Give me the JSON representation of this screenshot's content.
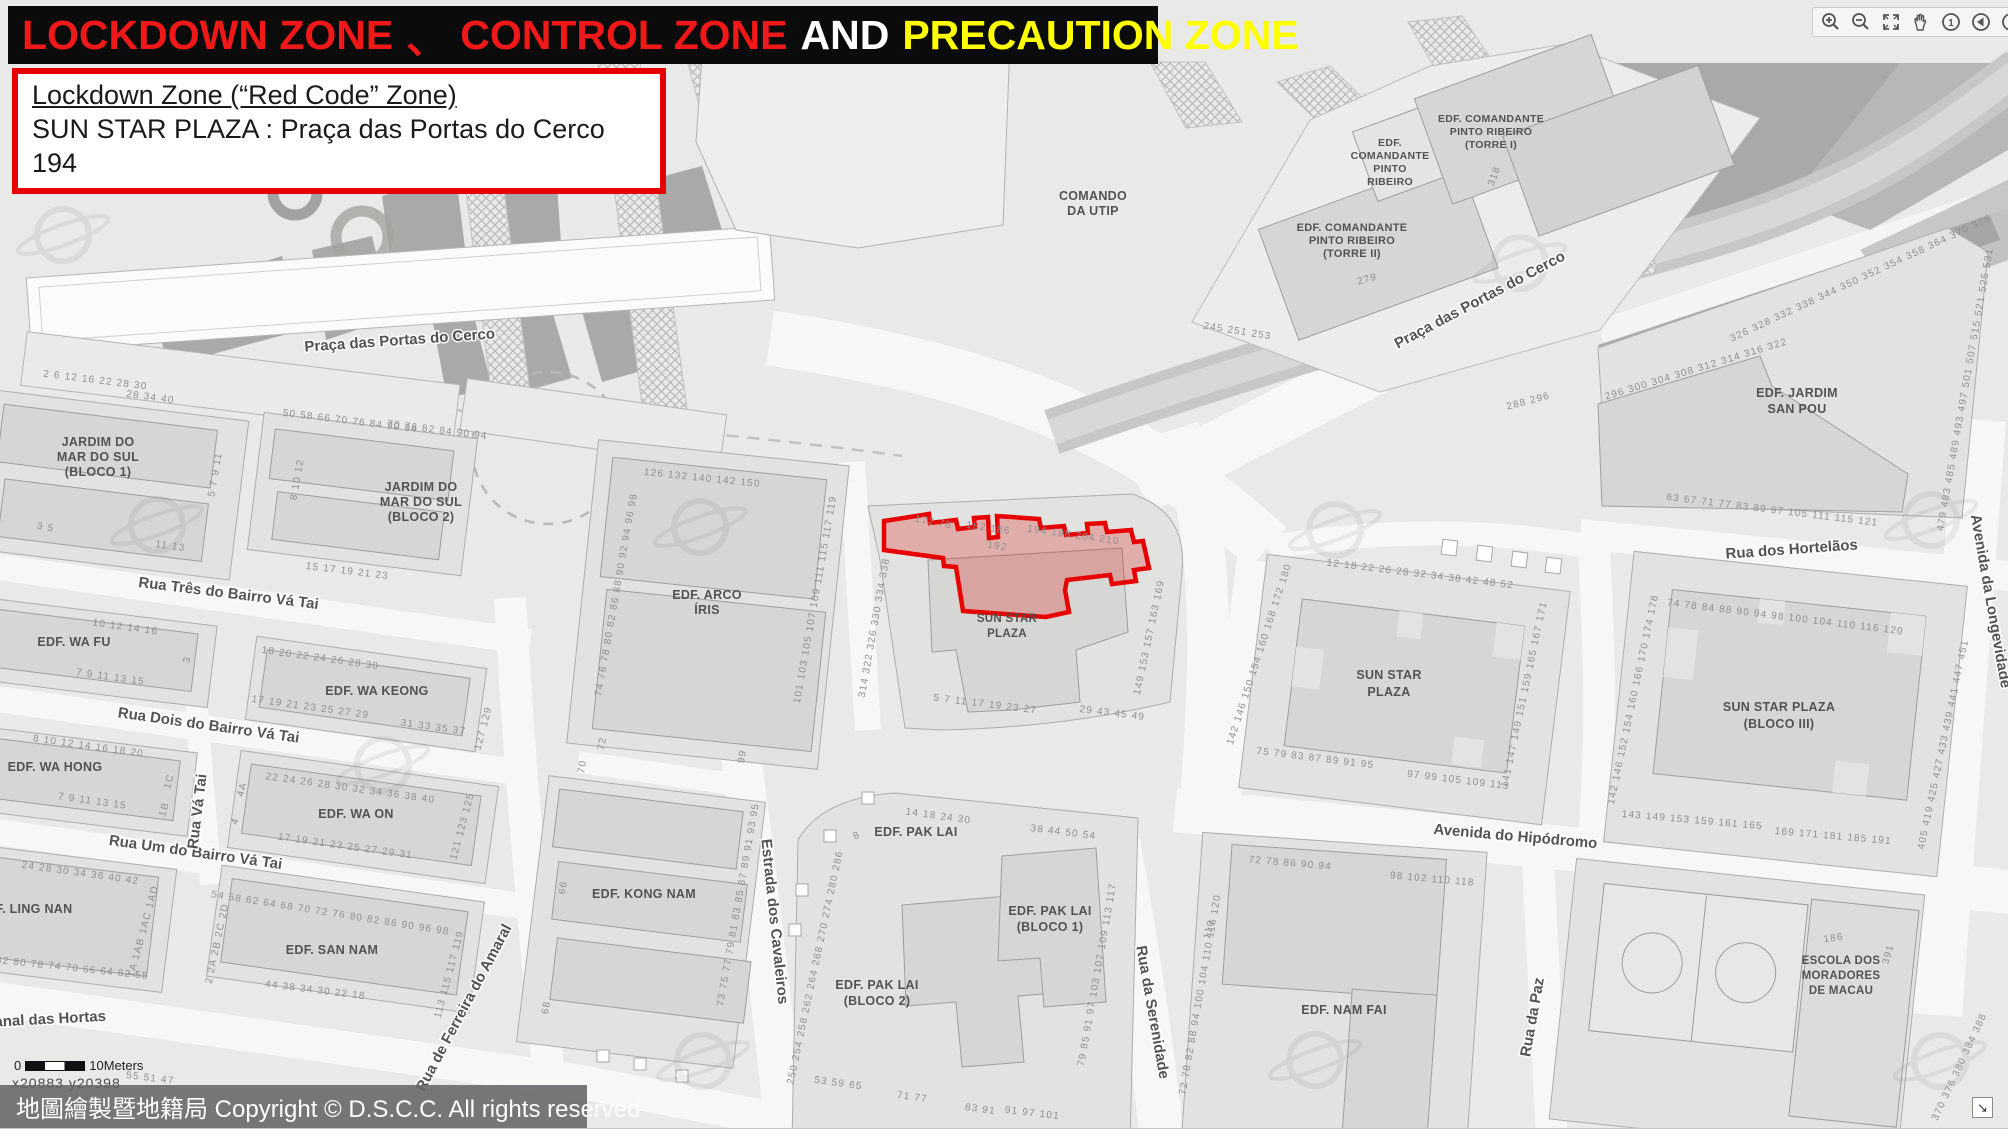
{
  "header": {
    "title_parts": [
      {
        "text": "LOCKDOWN ZONE",
        "color": "#f01818"
      },
      {
        "text": "、",
        "color": "#f01818"
      },
      {
        "text": "CONTROL ZONE",
        "color": "#f01818"
      },
      {
        "text": "AND",
        "color": "#ffffff"
      },
      {
        "text": "PRECAUTION ZONE",
        "color": "#ffff00"
      }
    ]
  },
  "info_box": {
    "line1": "Lockdown Zone (“Red Code” Zone)",
    "line2": "SUN STAR PLAZA :  Praça das Portas do Cerco 194"
  },
  "footer": {
    "copyright": "地圖繪製暨地籍局 Copyright © D.S.C.C. All rights reserved",
    "scale_zero": "0",
    "scale_label": "10Meters",
    "coords": "x20883  y20398"
  },
  "icons": {
    "home_digit": "1",
    "resize_arrow": "↘"
  },
  "colors": {
    "zone_stroke": "#e60000",
    "zone_fill": "rgba(220,30,30,0.27)"
  },
  "map": {
    "labels": [
      {
        "t": "Praça das Portas do Cerco",
        "x": 400,
        "y": 345,
        "r": -4,
        "k": "s"
      },
      {
        "t": "Praça das Portas do Cerco",
        "x": 1482,
        "y": 304,
        "r": -28,
        "k": "s"
      },
      {
        "t": "Rua Três do Bairro Vá Tai",
        "x": 228,
        "y": 598,
        "r": 7,
        "k": "s"
      },
      {
        "t": "Rua Dois do Bairro Vá Tai",
        "x": 208,
        "y": 730,
        "r": 8,
        "k": "s"
      },
      {
        "t": "Rua Um do Bairro Vá Tai",
        "x": 195,
        "y": 857,
        "r": 8,
        "k": "s"
      },
      {
        "t": "Rua Vá Tai",
        "x": 202,
        "y": 812,
        "r": -83,
        "k": "s"
      },
      {
        "t": "Canal das Hortas",
        "x": 45,
        "y": 1024,
        "r": -3,
        "k": "s"
      },
      {
        "t": "Rua de Ferreira do Amaral",
        "x": 468,
        "y": 1010,
        "r": -62,
        "k": "s"
      },
      {
        "t": "Estrada dos Cavaleiros",
        "x": 770,
        "y": 922,
        "r": 84,
        "k": "s"
      },
      {
        "t": "Rua da Serenidade",
        "x": 1148,
        "y": 1013,
        "r": 80,
        "k": "s"
      },
      {
        "t": "Avenida do Hipódromo",
        "x": 1515,
        "y": 841,
        "r": 5,
        "k": "s"
      },
      {
        "t": "Rua dos Hortelãos",
        "x": 1792,
        "y": 554,
        "r": -4,
        "k": "s"
      },
      {
        "t": "Avenida da Longevidade",
        "x": 1986,
        "y": 602,
        "r": 80,
        "k": "s"
      },
      {
        "t": "Rua da Paz",
        "x": 1537,
        "y": 1018,
        "r": -80,
        "k": "s"
      },
      {
        "t": "JARDIM DO",
        "x": 98,
        "y": 446,
        "r": 0,
        "k": "b"
      },
      {
        "t": "MAR DO SUL",
        "x": 98,
        "y": 461,
        "r": 0,
        "k": "b"
      },
      {
        "t": "(BLOCO 1)",
        "x": 98,
        "y": 476,
        "r": 0,
        "k": "b"
      },
      {
        "t": "JARDIM DO",
        "x": 421,
        "y": 491,
        "r": 0,
        "k": "b"
      },
      {
        "t": "MAR DO SUL",
        "x": 421,
        "y": 506,
        "r": 0,
        "k": "b"
      },
      {
        "t": "(BLOCO 2)",
        "x": 421,
        "y": 521,
        "r": 0,
        "k": "b"
      },
      {
        "t": "EDF. WA FU",
        "x": 74,
        "y": 646,
        "r": 0,
        "k": "b"
      },
      {
        "t": "EDF. WA KEONG",
        "x": 377,
        "y": 695,
        "r": 0,
        "k": "b"
      },
      {
        "t": "EDF. WA HONG",
        "x": 55,
        "y": 771,
        "r": 0,
        "k": "b"
      },
      {
        "t": "EDF. WA ON",
        "x": 356,
        "y": 818,
        "r": 0,
        "k": "b"
      },
      {
        "t": "EDF. LING NAN",
        "x": 25,
        "y": 913,
        "r": 0,
        "k": "b"
      },
      {
        "t": "EDF. SAN NAM",
        "x": 332,
        "y": 954,
        "r": 0,
        "k": "b"
      },
      {
        "t": "EDF. ARCO",
        "x": 707,
        "y": 599,
        "r": 0,
        "k": "b"
      },
      {
        "t": "ÍRIS",
        "x": 707,
        "y": 614,
        "r": 0,
        "k": "b"
      },
      {
        "t": "EDF. KONG NAM",
        "x": 644,
        "y": 898,
        "r": 0,
        "k": "b"
      },
      {
        "t": "SUN STAR",
        "x": 1007,
        "y": 622,
        "r": 0,
        "k": "b",
        "sz": 11.5
      },
      {
        "t": "PLAZA",
        "x": 1007,
        "y": 637,
        "r": 0,
        "k": "b",
        "sz": 11.5
      },
      {
        "t": "SUN STAR",
        "x": 1389,
        "y": 679,
        "r": 0,
        "k": "b"
      },
      {
        "t": "PLAZA",
        "x": 1389,
        "y": 696,
        "r": 0,
        "k": "b"
      },
      {
        "t": "SUN STAR PLAZA",
        "x": 1779,
        "y": 711,
        "r": 0,
        "k": "b"
      },
      {
        "t": "(BLOCO III)",
        "x": 1779,
        "y": 728,
        "r": 0,
        "k": "b"
      },
      {
        "t": "EDF. PAK LAI",
        "x": 916,
        "y": 836,
        "r": 0,
        "k": "b"
      },
      {
        "t": "EDF. PAK LAI",
        "x": 877,
        "y": 989,
        "r": 0,
        "k": "b"
      },
      {
        "t": "(BLOCO 2)",
        "x": 877,
        "y": 1005,
        "r": 0,
        "k": "b"
      },
      {
        "t": "EDF. PAK LAI",
        "x": 1050,
        "y": 915,
        "r": 0,
        "k": "b"
      },
      {
        "t": "(BLOCO 1)",
        "x": 1050,
        "y": 931,
        "r": 0,
        "k": "b"
      },
      {
        "t": "EDF. NAM FAI",
        "x": 1344,
        "y": 1014,
        "r": 0,
        "k": "b"
      },
      {
        "t": "EDF. JARDIM",
        "x": 1797,
        "y": 397,
        "r": 0,
        "k": "b"
      },
      {
        "t": "SAN POU",
        "x": 1797,
        "y": 413,
        "r": 0,
        "k": "b"
      },
      {
        "t": "COMANDO",
        "x": 1093,
        "y": 200,
        "r": 0,
        "k": "b"
      },
      {
        "t": "DA UTIP",
        "x": 1093,
        "y": 215,
        "r": 0,
        "k": "b"
      },
      {
        "t": "EDF.",
        "x": 1390,
        "y": 146,
        "r": 0,
        "k": "b",
        "sz": 10.5
      },
      {
        "t": "COMANDANTE",
        "x": 1390,
        "y": 159,
        "r": 0,
        "k": "b",
        "sz": 10.5
      },
      {
        "t": "PINTO",
        "x": 1390,
        "y": 172,
        "r": 0,
        "k": "b",
        "sz": 10.5
      },
      {
        "t": "RIBEIRO",
        "x": 1390,
        "y": 185,
        "r": 0,
        "k": "b",
        "sz": 10.5
      },
      {
        "t": "EDF. COMANDANTE",
        "x": 1491,
        "y": 122,
        "r": 0,
        "k": "b",
        "sz": 10.5
      },
      {
        "t": "PINTO RIBEIRO",
        "x": 1491,
        "y": 135,
        "r": 0,
        "k": "b",
        "sz": 10.5
      },
      {
        "t": "(TORRE I)",
        "x": 1491,
        "y": 148,
        "r": 0,
        "k": "b",
        "sz": 10.5
      },
      {
        "t": "EDF. COMANDANTE",
        "x": 1352,
        "y": 231,
        "r": 0,
        "k": "b",
        "sz": 11
      },
      {
        "t": "PINTO RIBEIRO",
        "x": 1352,
        "y": 244,
        "r": 0,
        "k": "b",
        "sz": 11
      },
      {
        "t": "(TORRE II)",
        "x": 1352,
        "y": 257,
        "r": 0,
        "k": "b",
        "sz": 11
      },
      {
        "t": "ESCOLA DOS",
        "x": 1841,
        "y": 964,
        "r": 0,
        "k": "b",
        "sz": 11.5
      },
      {
        "t": "MORADORES",
        "x": 1841,
        "y": 979,
        "r": 0,
        "k": "b",
        "sz": 11.5
      },
      {
        "t": "DE MACAU",
        "x": 1841,
        "y": 994,
        "r": 0,
        "k": "b",
        "sz": 11.5
      },
      {
        "t": "172  78",
        "x": 933,
        "y": 525,
        "r": 10,
        "k": "n"
      },
      {
        "t": "182  186",
        "x": 988,
        "y": 531,
        "r": 8,
        "k": "n"
      },
      {
        "t": "192",
        "x": 997,
        "y": 549,
        "r": 8,
        "k": "n"
      },
      {
        "t": "194  198 204 210",
        "x": 1073,
        "y": 538,
        "r": 8,
        "k": "n"
      },
      {
        "t": "314  322  326  330  334  338",
        "x": 877,
        "y": 628,
        "r": -80,
        "k": "n"
      },
      {
        "t": "5   7   11   17 19 23 27",
        "x": 985,
        "y": 707,
        "r": 7,
        "k": "n"
      },
      {
        "t": "29  43 45  49",
        "x": 1112,
        "y": 716,
        "r": 7,
        "k": "n"
      },
      {
        "t": "149  153  157  163  169",
        "x": 1152,
        "y": 638,
        "r": -78,
        "k": "n"
      },
      {
        "t": "126  132  140 142    150",
        "x": 702,
        "y": 481,
        "r": 6,
        "k": "n"
      },
      {
        "t": "74  76  78  80  82  86  88  90  92  94  96  98",
        "x": 619,
        "y": 595,
        "r": -80,
        "k": "n"
      },
      {
        "t": "101 103 105 107 109 111  115 117 119",
        "x": 818,
        "y": 600,
        "r": -80,
        "k": "n"
      },
      {
        "t": "70",
        "x": 585,
        "y": 767,
        "r": -80,
        "k": "n"
      },
      {
        "t": "72",
        "x": 605,
        "y": 744,
        "r": -80,
        "k": "n"
      },
      {
        "t": "99",
        "x": 745,
        "y": 757,
        "r": -80,
        "k": "n"
      },
      {
        "t": "73 75 77 79 81 83 85 87 89 91 93 95",
        "x": 741,
        "y": 905,
        "r": -80,
        "k": "n"
      },
      {
        "t": "66",
        "x": 566,
        "y": 888,
        "r": -80,
        "k": "n"
      },
      {
        "t": "68",
        "x": 549,
        "y": 1008,
        "r": -80,
        "k": "n"
      },
      {
        "t": "28  34  40",
        "x": 150,
        "y": 400,
        "r": 8,
        "k": "n"
      },
      {
        "t": "50  58   66  70  76   84  90  94",
        "x": 350,
        "y": 424,
        "r": 7,
        "k": "n"
      },
      {
        "t": "3   5",
        "x": 45,
        "y": 530,
        "r": 10,
        "k": "n"
      },
      {
        "t": "11   13",
        "x": 170,
        "y": 549,
        "r": 8,
        "k": "n"
      },
      {
        "t": "15   17   19   21   23",
        "x": 347,
        "y": 574,
        "r": 7,
        "k": "n"
      },
      {
        "t": "5  7  9  11",
        "x": 218,
        "y": 475,
        "r": -80,
        "k": "n"
      },
      {
        "t": "8  10  12",
        "x": 300,
        "y": 480,
        "r": -80,
        "k": "n"
      },
      {
        "t": "10   12   14   16",
        "x": 125,
        "y": 630,
        "r": 8,
        "k": "n"
      },
      {
        "t": "7   9   11   13  15",
        "x": 110,
        "y": 680,
        "r": 8,
        "k": "n"
      },
      {
        "t": "3",
        "x": 190,
        "y": 660,
        "r": -80,
        "k": "n"
      },
      {
        "t": "18   20 22 24   26 28 30",
        "x": 320,
        "y": 661,
        "r": 8,
        "k": "n"
      },
      {
        "t": "17   19 21 23   25 27 29",
        "x": 310,
        "y": 710,
        "r": 8,
        "k": "n"
      },
      {
        "t": "31  33  35  37",
        "x": 433,
        "y": 730,
        "r": 8,
        "k": "n"
      },
      {
        "t": "127  129",
        "x": 486,
        "y": 729,
        "r": -75,
        "k": "n"
      },
      {
        "t": "8   10   12   14   16 18 20",
        "x": 88,
        "y": 749,
        "r": 8,
        "k": "n"
      },
      {
        "t": "7   9   11   13 15",
        "x": 92,
        "y": 804,
        "r": 8,
        "k": "n"
      },
      {
        "t": "1C",
        "x": 172,
        "y": 782,
        "r": -75,
        "k": "n"
      },
      {
        "t": "1B",
        "x": 167,
        "y": 810,
        "r": -75,
        "k": "n"
      },
      {
        "t": "22   24   26   28   30   32   34   36 38 40",
        "x": 350,
        "y": 791,
        "r": 8,
        "k": "n"
      },
      {
        "t": "4A",
        "x": 245,
        "y": 790,
        "r": -75,
        "k": "n"
      },
      {
        "t": "4",
        "x": 238,
        "y": 822,
        "r": -70,
        "k": "n"
      },
      {
        "t": "17 19   21   23   25   27   29 31",
        "x": 345,
        "y": 849,
        "r": 8,
        "k": "n"
      },
      {
        "t": "121  123  125",
        "x": 465,
        "y": 827,
        "r": -75,
        "k": "n"
      },
      {
        "t": "24  28  30  34   36   40   42",
        "x": 80,
        "y": 876,
        "r": 8,
        "k": "n"
      },
      {
        "t": "1A 1AB 1AC 1AD",
        "x": 146,
        "y": 932,
        "r": -75,
        "k": "n"
      },
      {
        "t": "82 80 78 74  70 66 64 62  58",
        "x": 72,
        "y": 971,
        "r": 6,
        "k": "n"
      },
      {
        "t": "54   58 62   64 68 70 72   76 80 82   86 90 96 98",
        "x": 330,
        "y": 916,
        "r": 9,
        "k": "n"
      },
      {
        "t": "2  2A  2B  2C  2D",
        "x": 220,
        "y": 944,
        "r": -78,
        "k": "n"
      },
      {
        "t": "44      38      34      30      22      18",
        "x": 315,
        "y": 993,
        "r": 7,
        "k": "n"
      },
      {
        "t": "113  115  117  119",
        "x": 452,
        "y": 975,
        "r": -75,
        "k": "n"
      },
      {
        "t": "2   6   12 16 22 28 30",
        "x": 95,
        "y": 383,
        "r": 7,
        "k": "n"
      },
      {
        "t": "70  76  82  84  90  94",
        "x": 437,
        "y": 433,
        "r": 7,
        "k": "n"
      },
      {
        "t": "55   51   47",
        "x": 150,
        "y": 1081,
        "r": 7,
        "k": "n"
      },
      {
        "t": "250  254  258  262  264  268  270  274  280  286",
        "x": 818,
        "y": 968,
        "r": -78,
        "k": "n"
      },
      {
        "t": "8",
        "x": 858,
        "y": 838,
        "r": -30,
        "k": "n"
      },
      {
        "t": "14   18   24   30",
        "x": 938,
        "y": 819,
        "r": 8,
        "k": "n"
      },
      {
        "t": "38  44   50  54",
        "x": 1063,
        "y": 835,
        "r": 7,
        "k": "n"
      },
      {
        "t": "53   59   65",
        "x": 838,
        "y": 1086,
        "r": 8,
        "k": "n"
      },
      {
        "t": "71   77",
        "x": 912,
        "y": 1100,
        "r": 8,
        "k": "n"
      },
      {
        "t": "83   91",
        "x": 980,
        "y": 1112,
        "r": 8,
        "k": "n"
      },
      {
        "t": "79  85  91  97  103 107 109  113  117",
        "x": 1100,
        "y": 975,
        "r": -80,
        "k": "n"
      },
      {
        "t": "91   97   101",
        "x": 1032,
        "y": 1116,
        "r": 7,
        "k": "n"
      },
      {
        "t": "72  78  82  88  94  100  104  110  116  120",
        "x": 1203,
        "y": 995,
        "r": -80,
        "k": "n"
      },
      {
        "t": "72   78   86   90   94",
        "x": 1290,
        "y": 866,
        "r": 5,
        "k": "n"
      },
      {
        "t": "98  102  110  118",
        "x": 1432,
        "y": 882,
        "r": 5,
        "k": "n"
      },
      {
        "t": "110",
        "x": 1212,
        "y": 930,
        "r": -75,
        "k": "n"
      },
      {
        "t": "12   18   22   26   28   32   34   38   42   48   52",
        "x": 1420,
        "y": 577,
        "r": 7,
        "k": "n"
      },
      {
        "t": "142  146  150  154  160  168  172  180",
        "x": 1262,
        "y": 655,
        "r": -72,
        "k": "n"
      },
      {
        "t": "75   79   83   87   89   91   95",
        "x": 1315,
        "y": 761,
        "r": 7,
        "k": "n"
      },
      {
        "t": "97  99  105   109 113",
        "x": 1458,
        "y": 783,
        "r": 7,
        "k": "n"
      },
      {
        "t": "141  147  149  151  159  165  167  171",
        "x": 1527,
        "y": 695,
        "r": -78,
        "k": "n"
      },
      {
        "t": "74 78   84   88   90   94   98  100  104   110   116   120",
        "x": 1785,
        "y": 620,
        "r": 7,
        "k": "n"
      },
      {
        "t": "142  146  152  154  160  166  170  174  178",
        "x": 1636,
        "y": 700,
        "r": -78,
        "k": "n"
      },
      {
        "t": "405  419  425  427  433  439  441  447  451",
        "x": 1946,
        "y": 745,
        "r": -78,
        "k": "n"
      },
      {
        "t": "143  149  153  159  161  165",
        "x": 1692,
        "y": 823,
        "r": 5,
        "k": "n"
      },
      {
        "t": "169  171  181  185  191",
        "x": 1833,
        "y": 839,
        "r": 5,
        "k": "n"
      },
      {
        "t": "296  300  304  308  312  314  316  322",
        "x": 1697,
        "y": 372,
        "r": -17,
        "k": "n"
      },
      {
        "t": "326  328  332  338  344  350  352  354  358  364  370  376",
        "x": 1862,
        "y": 281,
        "r": -25,
        "k": "n"
      },
      {
        "t": "479  483  485  489  493  497  501  507  515  521  525  531",
        "x": 1968,
        "y": 390,
        "r": -80,
        "k": "n"
      },
      {
        "t": "63   67   71   77   83   89   97   105   111   115   121",
        "x": 1772,
        "y": 513,
        "r": 7,
        "k": "n"
      },
      {
        "t": "318",
        "x": 1497,
        "y": 177,
        "r": -70,
        "k": "n"
      },
      {
        "t": "279",
        "x": 1368,
        "y": 282,
        "r": -15,
        "k": "n"
      },
      {
        "t": "245   251  253",
        "x": 1237,
        "y": 334,
        "r": 9,
        "k": "n"
      },
      {
        "t": "288  296",
        "x": 1529,
        "y": 404,
        "r": -15,
        "k": "n"
      },
      {
        "t": "186",
        "x": 1834,
        "y": 941,
        "r": -8,
        "k": "n"
      },
      {
        "t": "391",
        "x": 1891,
        "y": 955,
        "r": -75,
        "k": "n"
      },
      {
        "t": "370  376  380  384  388",
        "x": 1962,
        "y": 1068,
        "r": -65,
        "k": "n"
      }
    ]
  }
}
